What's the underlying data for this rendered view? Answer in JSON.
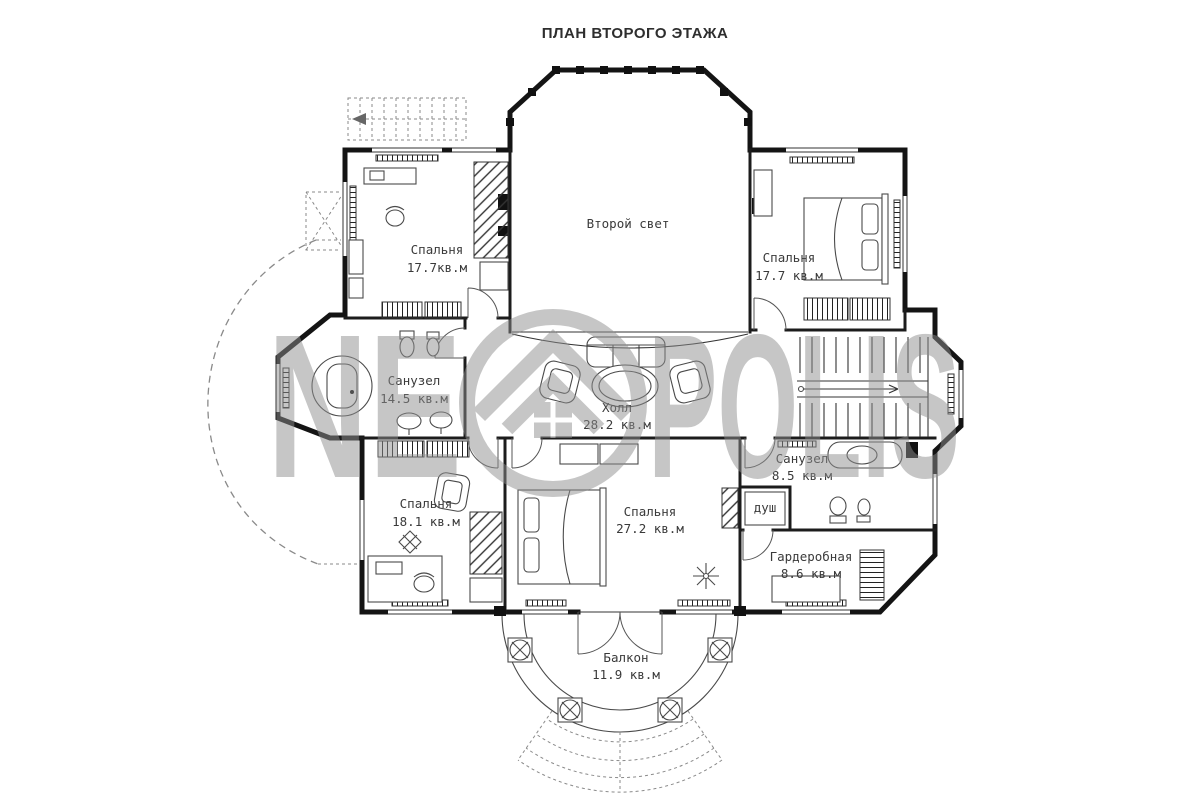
{
  "title": "ПЛАН ВТОРОГО ЭТАЖА",
  "watermark": {
    "left": "NE",
    "right": "POLIS"
  },
  "rooms": {
    "bedroom_top_left": {
      "name": "Спальня",
      "area": "17.7кв.м"
    },
    "second_light": {
      "name": "Второй свет"
    },
    "bedroom_top_right": {
      "name": "Спальня",
      "area": "17.7 кв.м"
    },
    "bathroom_left": {
      "name": "Санузел",
      "area": "14.5 кв.м"
    },
    "hall": {
      "name": "Холл",
      "area": "28.2 кв.м"
    },
    "bathroom_right": {
      "name": "Санузел",
      "area": "8.5 кв.м"
    },
    "shower": {
      "name": "душ"
    },
    "bedroom_bottom_left": {
      "name": "Спальня",
      "area": "18.1 кв.м"
    },
    "bedroom_bottom_center": {
      "name": "Спальня",
      "area": "27.2 кв.м"
    },
    "wardrobe": {
      "name": "Гардеробная",
      "area": "8.6 кв.м"
    },
    "balcony": {
      "name": "Балкон",
      "area": "11.9 кв.м"
    }
  }
}
